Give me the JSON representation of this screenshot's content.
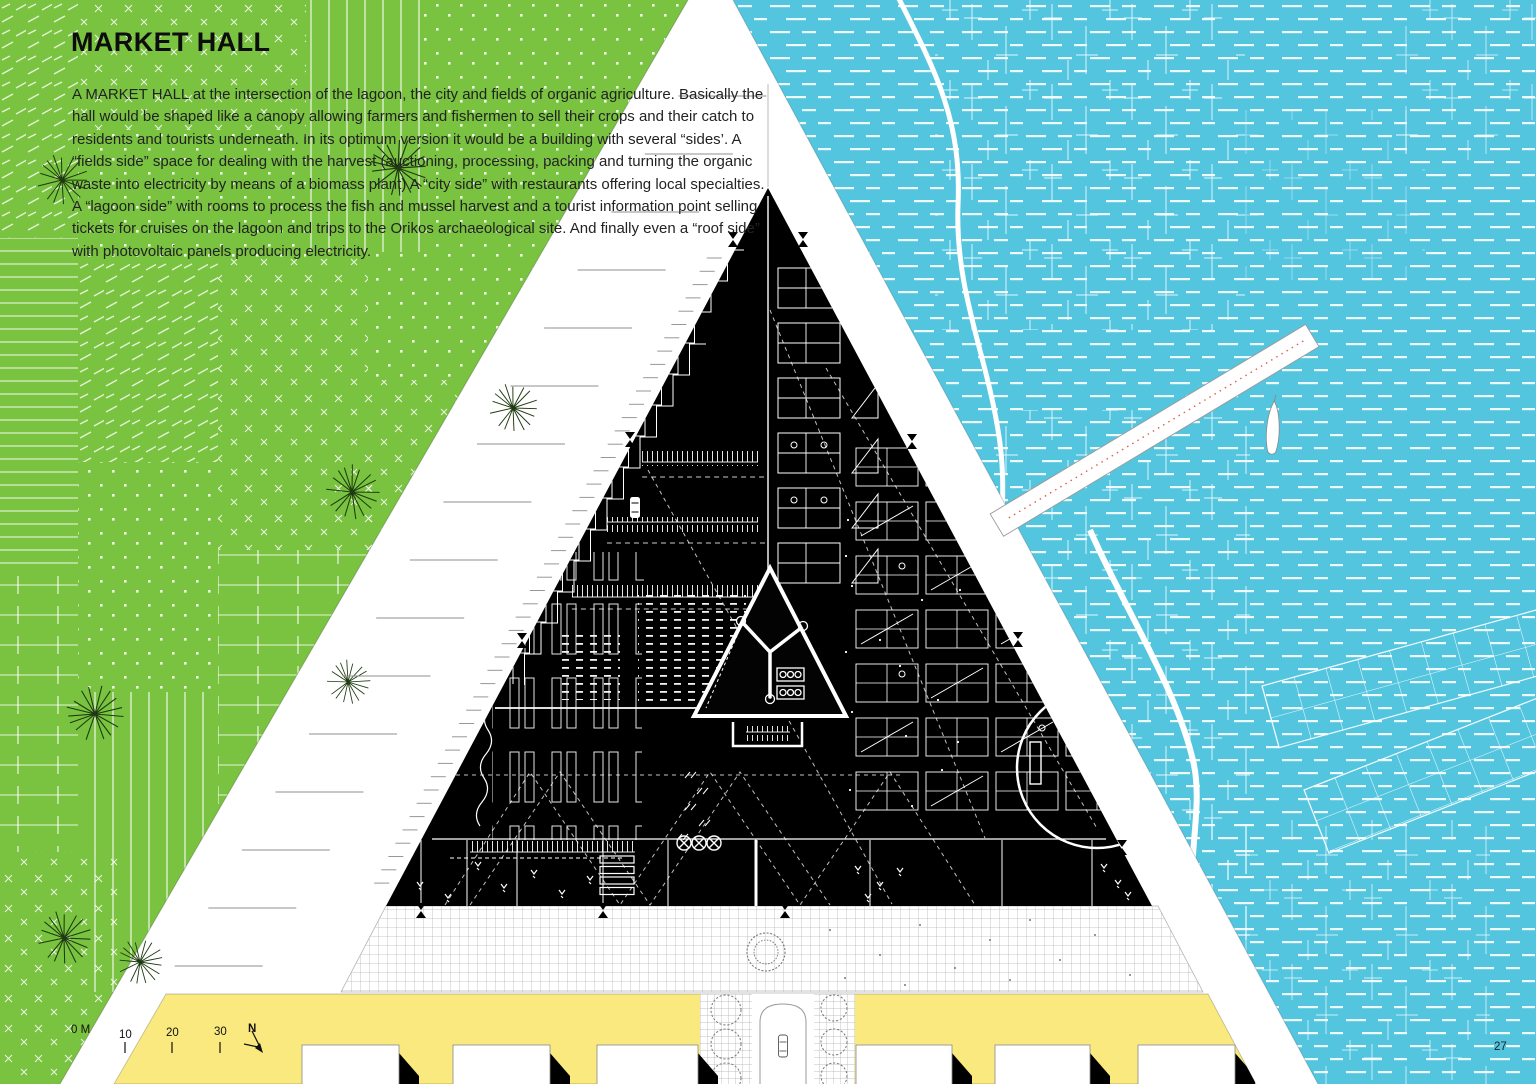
{
  "page": {
    "title": "MARKET HALL",
    "paragraph": "A MARKET HALL at the intersection of the lagoon, the city and fields of organic agriculture. Basically the hall would be shaped like a canopy allowing farmers and fishermen to sell their crops and their catch to residents and tourists underneath. In its optimum version it would be a building with several “sides’. A “fields side” space for dealing with the harvest (auctioning, processing, packing and turning the organic waste into electricity by means of a biomass plant) A “city side” with restaurants offering local specialties. A “lagoon side” with rooms to process the fish and mussel harvest and a tourist information point selling tickets for cruises on the lagoon and trips to the Orikos archaeological site. And finally even a “roof side” with photovoltaic panels producing electricity.",
    "page_number": "27"
  },
  "scale_bar": {
    "labels": [
      "0 M",
      "10",
      "20",
      "30"
    ],
    "north_label": "N"
  },
  "colors": {
    "field_green": "#7ac340",
    "water_blue": "#53c5df",
    "city_yellow": "#f9e97f",
    "hall_black": "#000000",
    "pier_centerline_red": "#e05a5a",
    "drawing_gray": "#8f8f8f"
  }
}
